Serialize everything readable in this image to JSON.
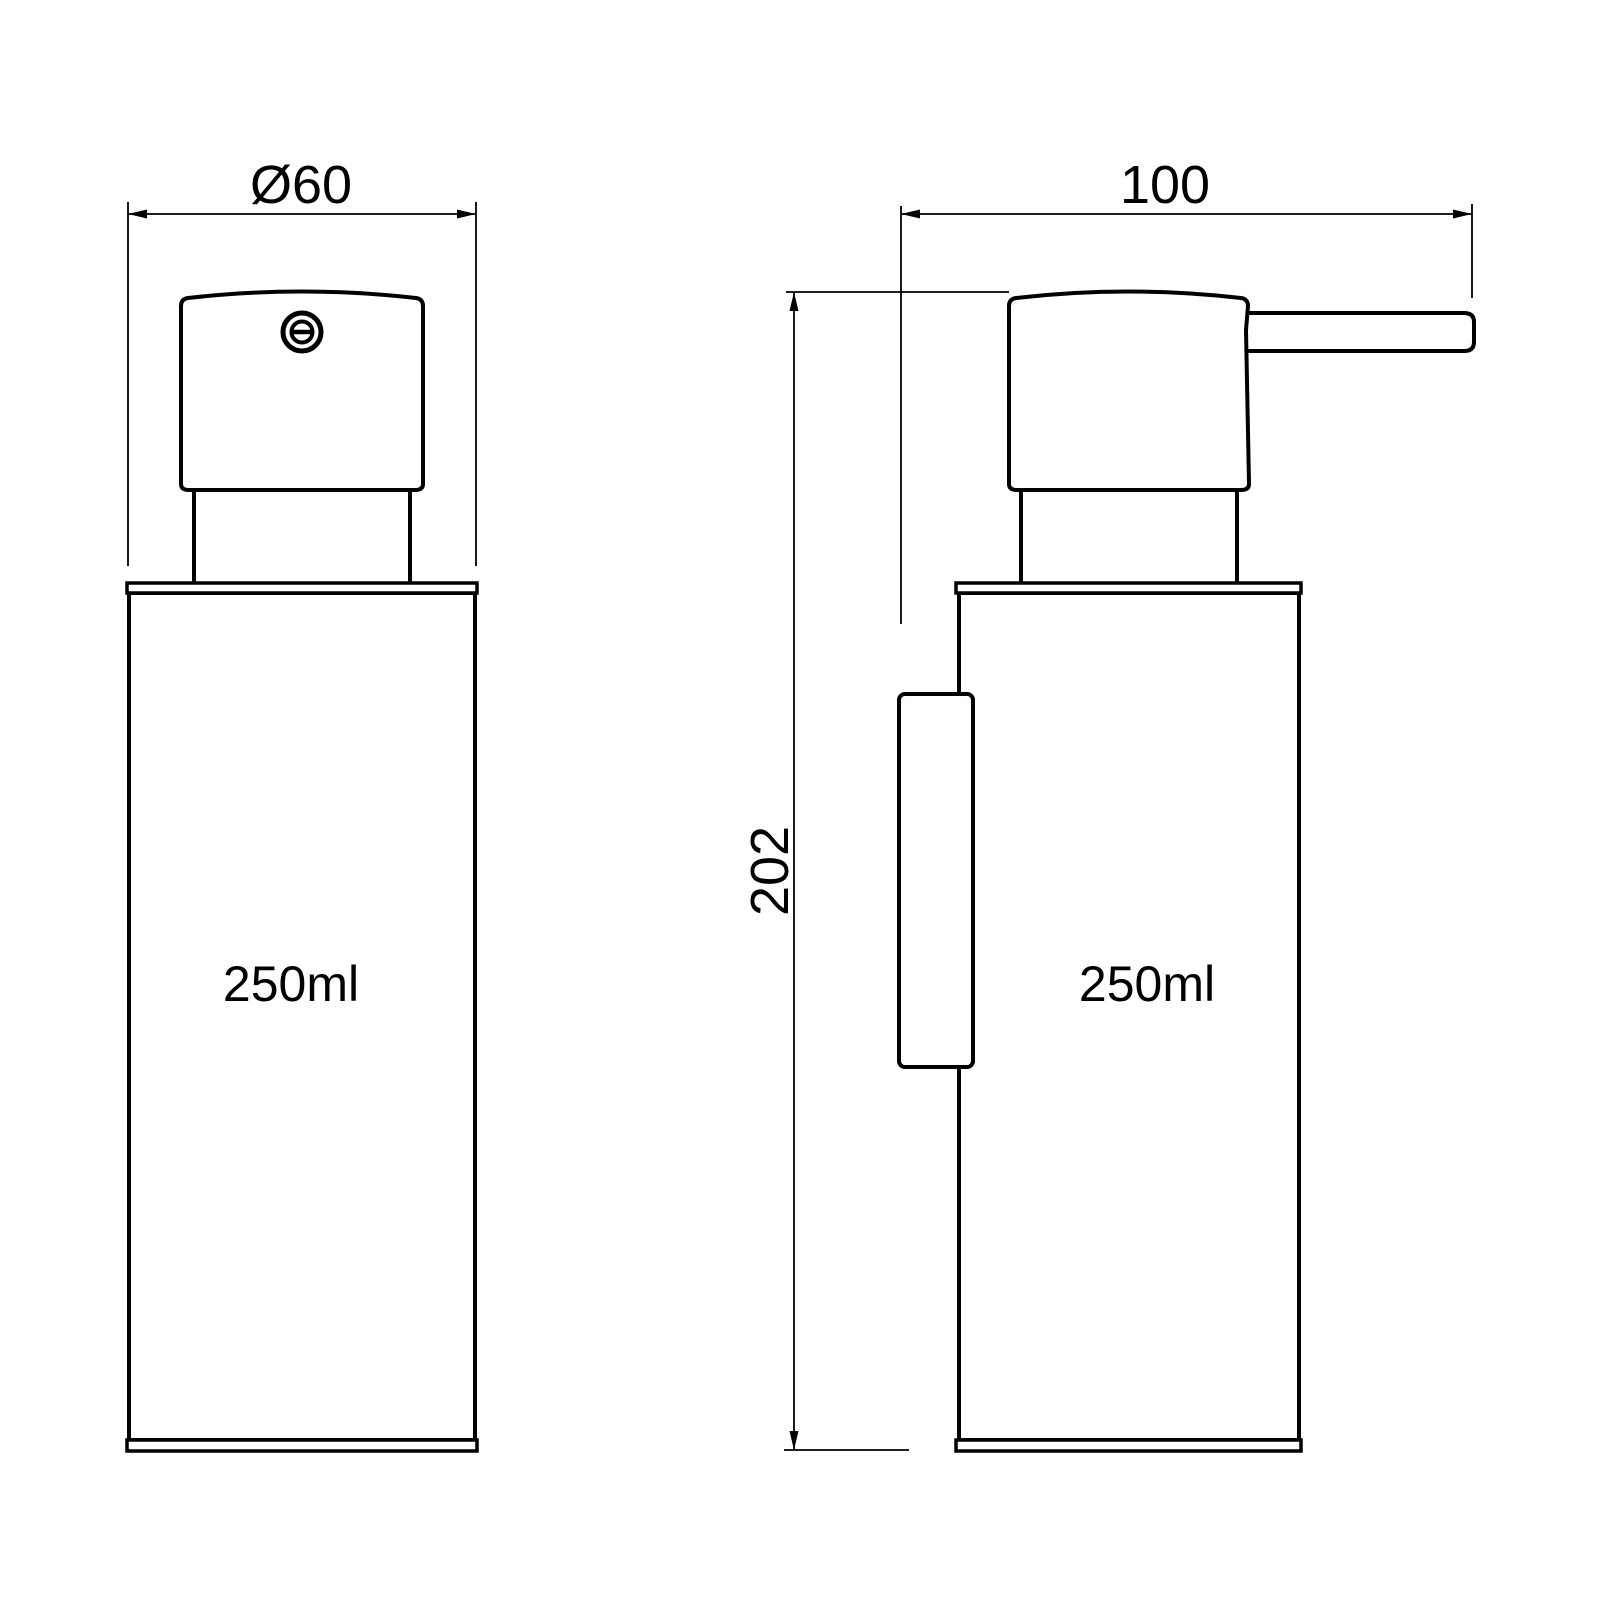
{
  "drawing": {
    "background_color": "#ffffff",
    "line_color": "#000000",
    "front_view": {
      "diameter_dimension": "Ø60",
      "capacity_label": "250ml"
    },
    "side_view": {
      "depth_dimension": "100",
      "height_dimension": "202",
      "capacity_label": "250ml"
    }
  }
}
